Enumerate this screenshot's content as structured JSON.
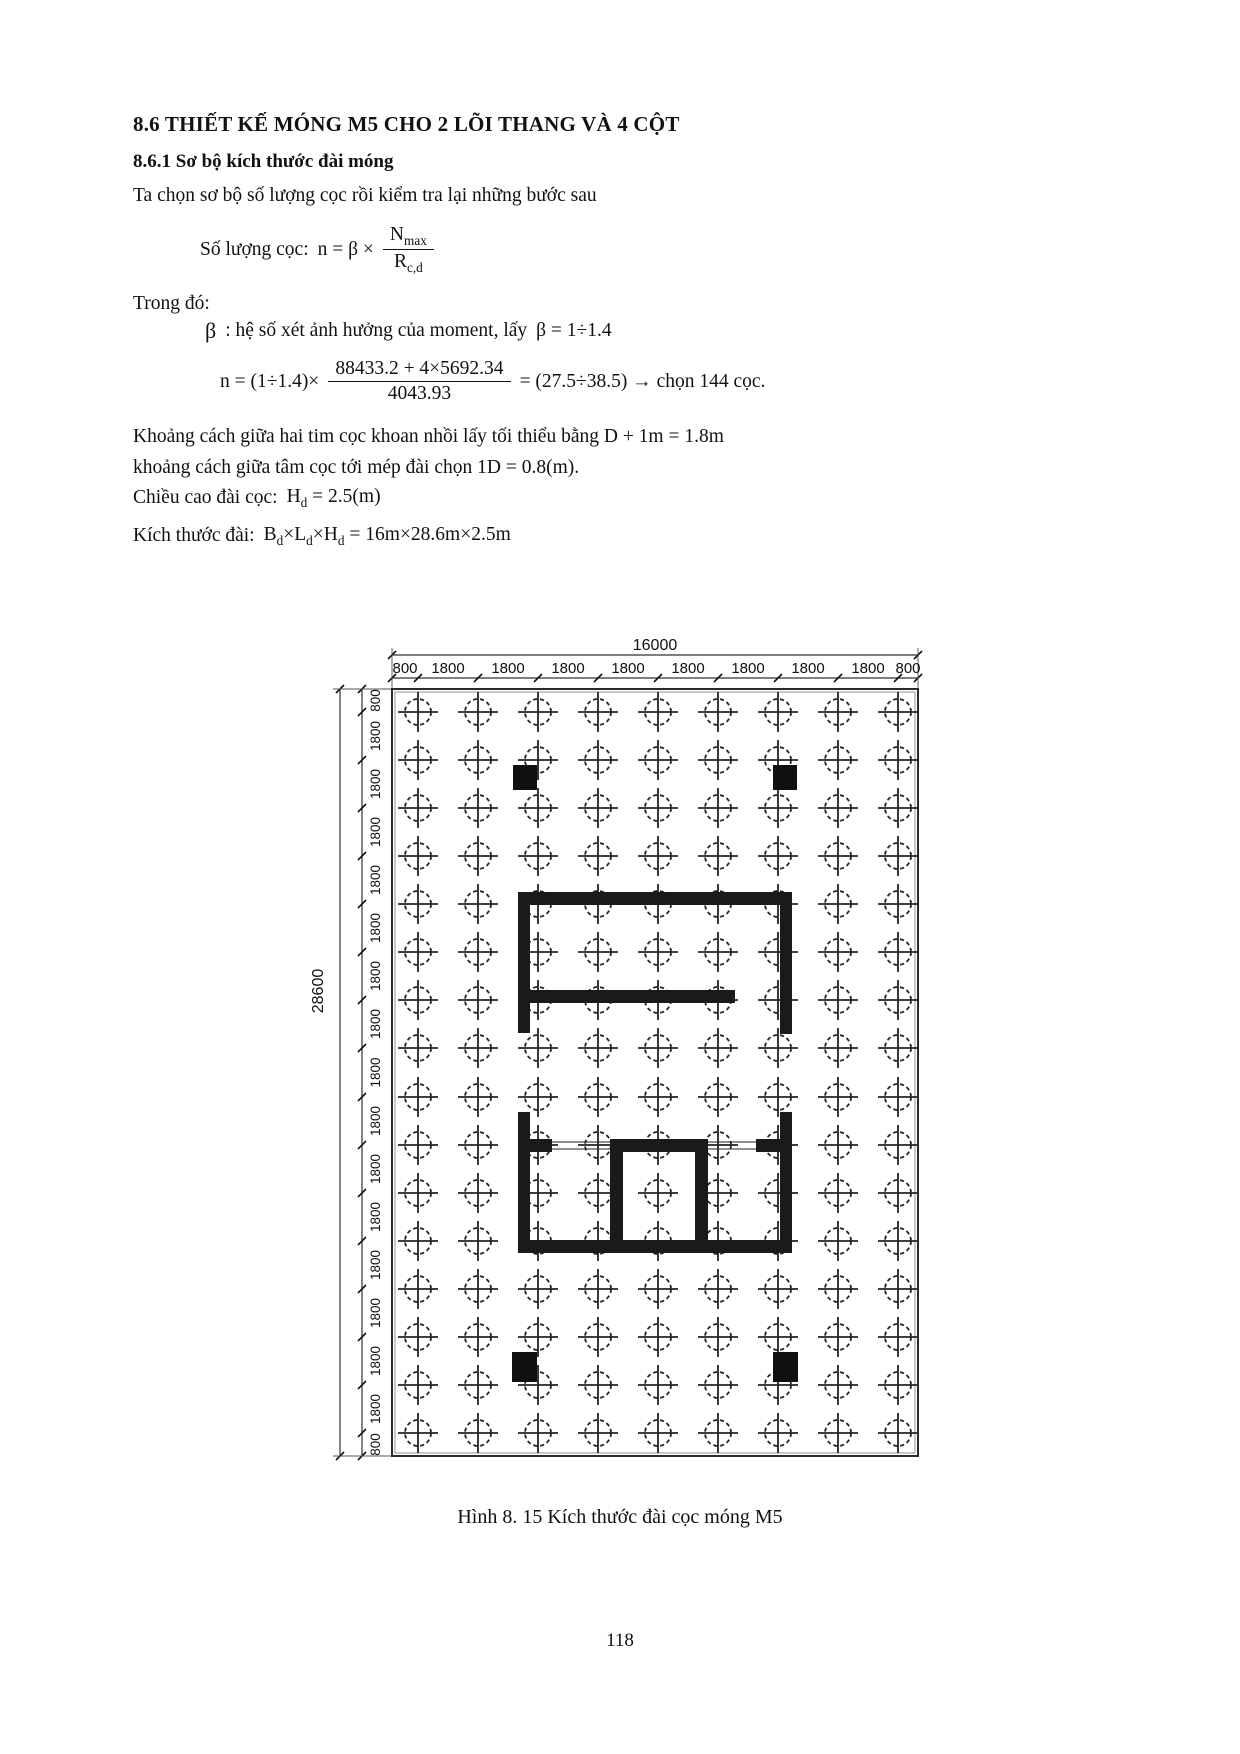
{
  "doc": {
    "heading1": "8.6 THIẾT KẾ MÓNG M5 CHO 2 LÕI THANG VÀ 4 CỘT",
    "heading2": "8.6.1 Sơ bộ kích thước đài móng",
    "intro": "Ta chọn sơ bộ số lượng cọc rồi kiểm tra lại những bước sau",
    "formula_count": {
      "label": "Số lượng cọc:",
      "lhs": "n = β ×",
      "num_base": "N",
      "num_sub": "max",
      "den_base": "R",
      "den_sub": "c,d"
    },
    "trong_do": "Trong đó:",
    "beta_symbol": "β",
    "beta_note": ": hệ số xét ảnh hưởng của moment, lấy",
    "beta_value": "β = 1÷1.4",
    "formula_n": {
      "lhs": "n = (1÷1.4)×",
      "num": "88433.2 + 4×5692.34",
      "den": "4043.93",
      "rhs": "= (27.5÷38.5) → chọn 144 cọc."
    },
    "spacing1": "Khoảng cách giữa hai tim cọc khoan nhồi lấy tối thiểu bằng D + 1m = 1.8m",
    "spacing2": "khoảng cách giữa tâm cọc tới mép đài chọn 1D = 0.8(m).",
    "height_label": "Chiều cao đài cọc:",
    "height_formula": {
      "base": "H",
      "sub": "d",
      "rest": "= 2.5(m)"
    },
    "size_label": "Kích thước đài:",
    "size_formula": {
      "b": "B",
      "b_sub": "d",
      "x1": "×",
      "l": "L",
      "l_sub": "d",
      "x2": "×",
      "h": "H",
      "h_sub": "d",
      "rest": "= 16m×28.6m×2.5m"
    },
    "caption": "Hình 8. 15 Kích thước đài cọc móng M5",
    "page_number": "118"
  },
  "figure": {
    "total_width_label": "16000",
    "total_height_label": "28600",
    "top_segments": [
      "800",
      "1800",
      "1800",
      "1800",
      "1800",
      "1800",
      "1800",
      "1800",
      "1800",
      "800"
    ],
    "left_segments": [
      "800",
      "1800",
      "1800",
      "1800",
      "1800",
      "1800",
      "1800",
      "1800",
      "1800",
      "1800",
      "1800",
      "1800",
      "1800",
      "1800",
      "1800",
      "1800",
      "800"
    ],
    "grid": {
      "cols": 9,
      "rows": 16,
      "pile_count": 144
    }
  }
}
